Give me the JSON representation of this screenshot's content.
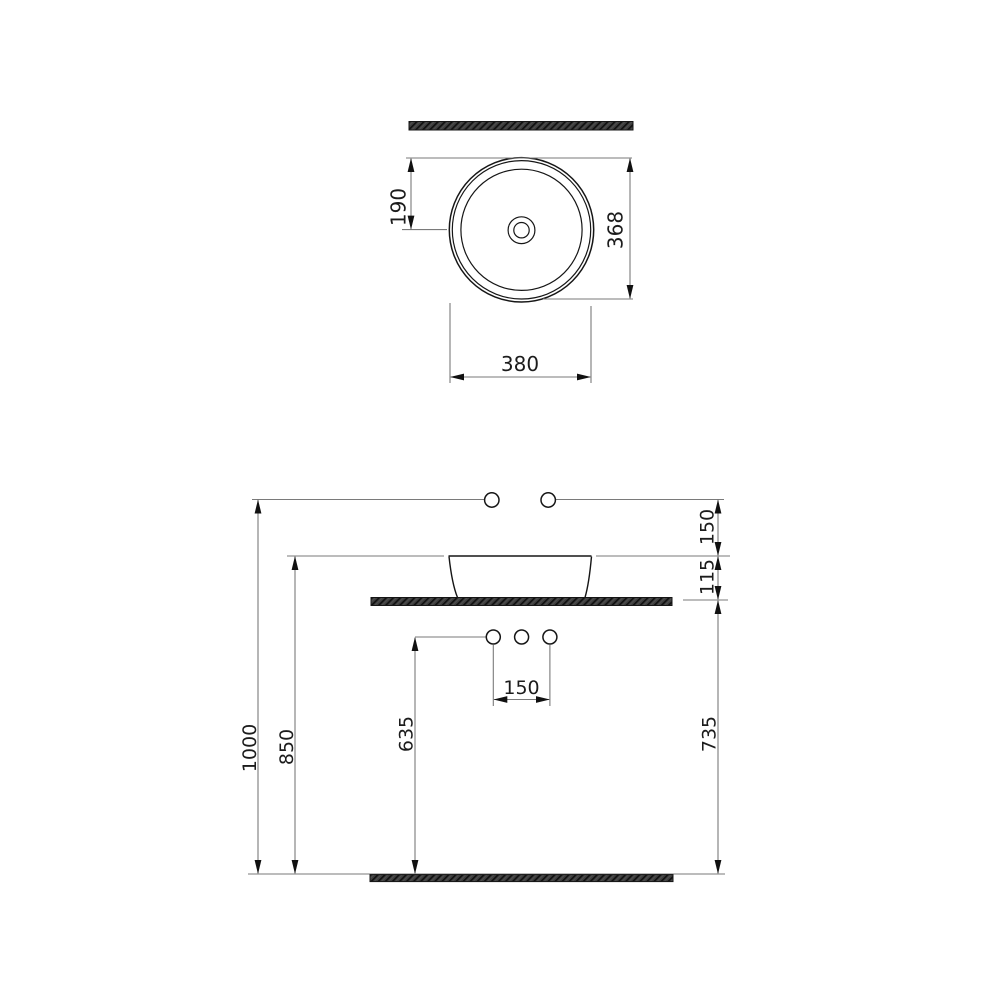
{
  "drawing": {
    "type": "sanitary-ware installation drawing (countertop round washbasin)",
    "background_color": "#ffffff",
    "object_line_color": "#161616",
    "dimension_line_color": "#7a7a7a",
    "section_fill_color": "#3d3d3d",
    "views": {
      "top": {
        "name": "top view",
        "dimensions": {
          "rim_to_center": "190",
          "depth": "368",
          "width": "380"
        }
      },
      "front": {
        "name": "front view",
        "dimensions": {
          "supply_above_rim": "150",
          "rim_above_counter": "115",
          "hole_spacing": "150",
          "drain_outlet_height": "635",
          "rim_height": "850",
          "supply_height": "1000",
          "counter_height": "735"
        }
      }
    }
  }
}
